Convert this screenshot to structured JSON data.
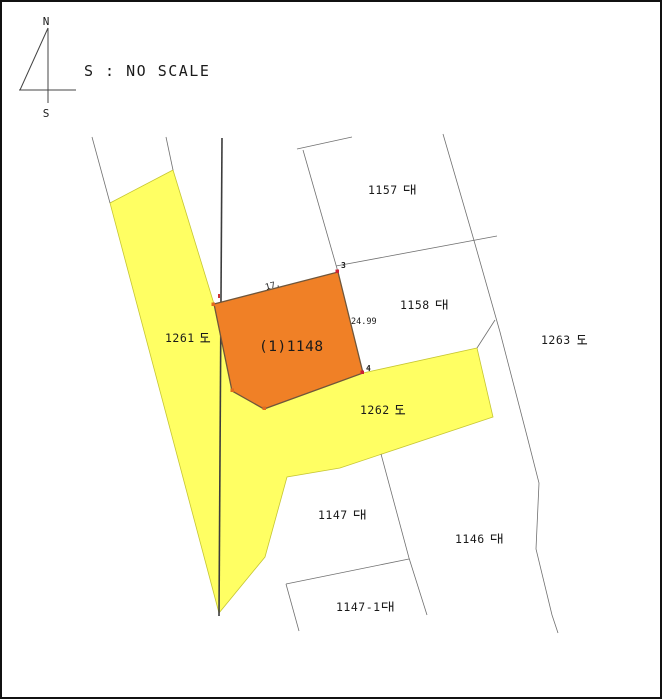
{
  "compass": {
    "north": "N",
    "south": "S"
  },
  "scale_note": "S : NO SCALE",
  "map": {
    "subject_parcel": {
      "label": "(1)1148",
      "parcel_number": "1148"
    },
    "parcels": [
      {
        "label": "1157 대",
        "number": "1157",
        "suffix": "대",
        "type": "site"
      },
      {
        "label": "1158 대",
        "number": "1158",
        "suffix": "대",
        "type": "site"
      },
      {
        "label": "1147 대",
        "number": "1147",
        "suffix": "대",
        "type": "site"
      },
      {
        "label": "1146 대",
        "number": "1146",
        "suffix": "대",
        "type": "site"
      },
      {
        "label": "1147-1 대",
        "number": "1147-1",
        "suffix": "대",
        "type": "site"
      }
    ],
    "roads": [
      {
        "label": "1261 도",
        "number": "1261",
        "suffix": "도",
        "type": "road"
      },
      {
        "label": "1262 도",
        "number": "1262",
        "suffix": "도",
        "type": "road"
      },
      {
        "label": "1263 도",
        "number": "1263",
        "suffix": "도",
        "type": "road"
      }
    ],
    "dimensions": [
      {
        "label": "24.99"
      },
      {
        "label": "17."
      }
    ],
    "vertex_labels": [
      {
        "label": "3"
      },
      {
        "label": "4"
      }
    ],
    "colors": {
      "road_fill": "#ffff63",
      "road_edge": "#c6c632",
      "subject_fill": "#f08026",
      "subject_edge": "#70563a",
      "subject_label_red": "#ff1f1f",
      "dimension_red": "#cc4466",
      "boundary_gray": "#707070"
    }
  }
}
